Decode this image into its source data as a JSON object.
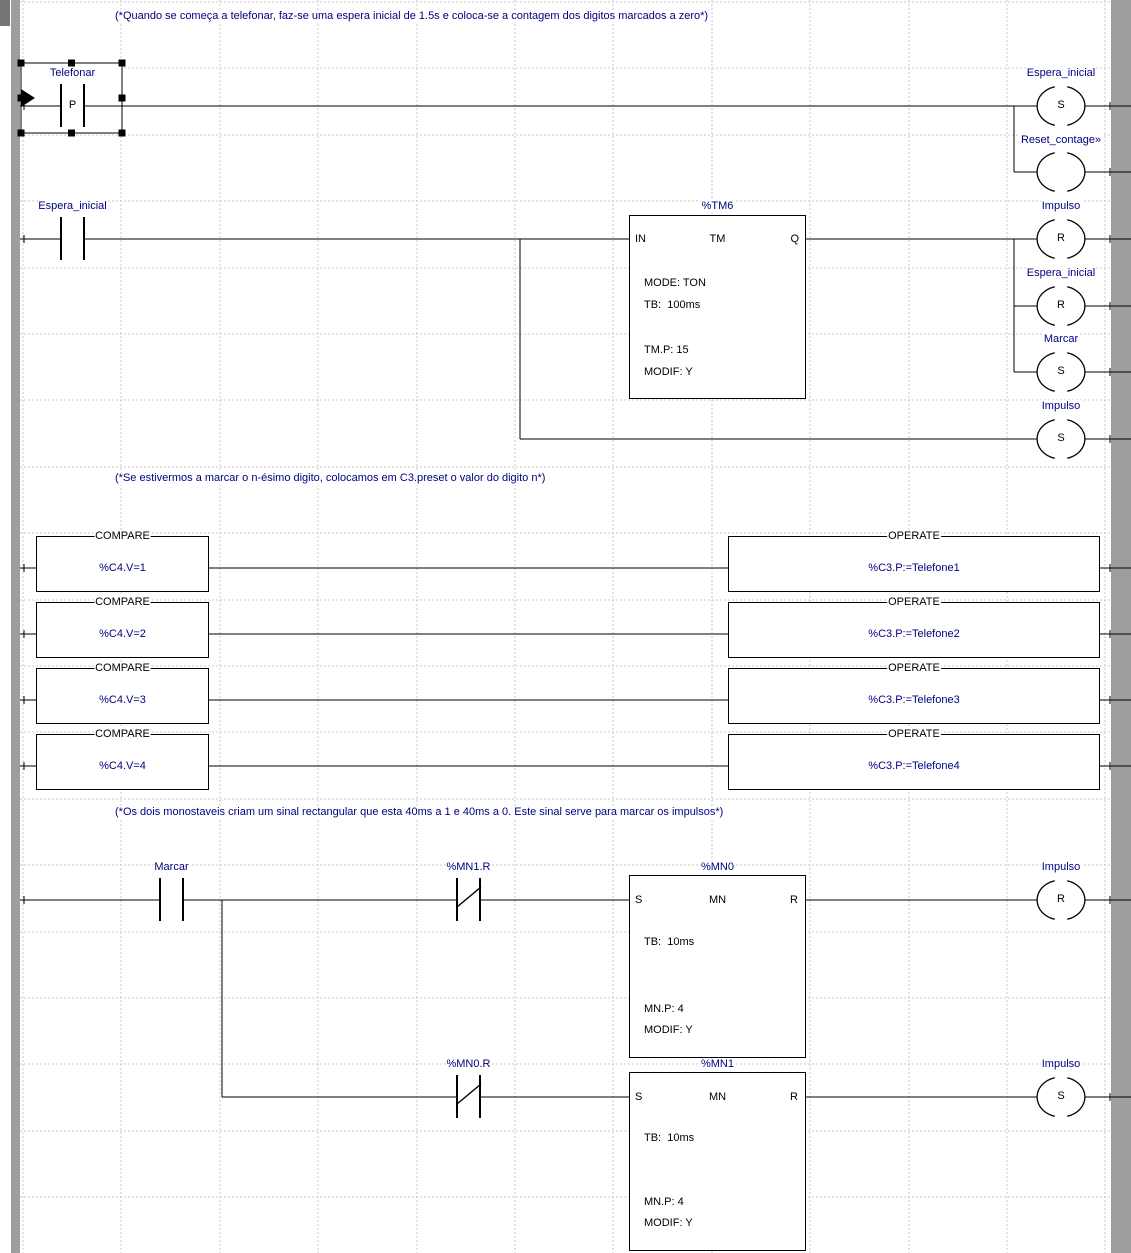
{
  "colors": {
    "label_blue": "#000080",
    "line_black": "#000000",
    "rail_gray": "#9e9e9e",
    "corner_gray": "#757575",
    "grid_gray": "#c9c9c9"
  },
  "comments": [
    "(*Quando se começa a telefonar, faz-se uma espera inicial de 1.5s e coloca-se a contagem dos digitos marcados a zero*)",
    "(*Se estivermos a marcar o n-ésimo digito, colocamos em C3.preset o valor do digito n*)",
    "(*Os dois monostaveis criam um sinal rectangular que esta 40ms a 1 e 40ms a 0. Este sinal serve para marcar os impulsos*)"
  ],
  "network1": {
    "contact_telefonar": {
      "label": "Telefonar",
      "edge": "P"
    },
    "coil_espera_set": {
      "label": "Espera_inicial",
      "op": "S"
    },
    "coil_reset_contagem": {
      "label": "Reset_contage»",
      "op": ""
    },
    "contact_espera": {
      "label": "Espera_inicial"
    },
    "timer": {
      "name": "%TM6",
      "pin_in": "IN",
      "pin_fn": "TM",
      "pin_q": "Q",
      "line_mode": "MODE: TON",
      "line_tb": "TB:  100ms",
      "line_preset": "TM.P: 15",
      "line_modif": "MODIF: Y"
    },
    "coil_impulso_r": {
      "label": "Impulso",
      "op": "R"
    },
    "coil_espera_r": {
      "label": "Espera_inicial",
      "op": "R"
    },
    "coil_marcar_s": {
      "label": "Marcar",
      "op": "S"
    },
    "coil_impulso_s": {
      "label": "Impulso",
      "op": "S"
    }
  },
  "network2": {
    "rows": [
      {
        "compare": "COMPARE",
        "expr": "%C4.V=1",
        "operate": "OPERATE",
        "assign": "%C3.P:=Telefone1"
      },
      {
        "compare": "COMPARE",
        "expr": "%C4.V=2",
        "operate": "OPERATE",
        "assign": "%C3.P:=Telefone2"
      },
      {
        "compare": "COMPARE",
        "expr": "%C4.V=3",
        "operate": "OPERATE",
        "assign": "%C3.P:=Telefone3"
      },
      {
        "compare": "COMPARE",
        "expr": "%C4.V=4",
        "operate": "OPERATE",
        "assign": "%C3.P:=Telefone4"
      }
    ]
  },
  "network3": {
    "contact_marcar": {
      "label": "Marcar"
    },
    "contact_mn1r": {
      "label": "%MN1.R"
    },
    "mono0": {
      "name": "%MN0",
      "pin_s": "S",
      "pin_fn": "MN",
      "pin_r": "R",
      "line_tb": "TB:  10ms",
      "line_preset": "MN.P: 4",
      "line_modif": "MODIF: Y"
    },
    "coil_impulso_r": {
      "label": "Impulso",
      "op": "R"
    },
    "contact_mn0r": {
      "label": "%MN0.R"
    },
    "mono1": {
      "name": "%MN1",
      "pin_s": "S",
      "pin_fn": "MN",
      "pin_r": "R",
      "line_tb": "TB:  10ms",
      "line_preset": "MN.P: 4",
      "line_modif": "MODIF: Y"
    },
    "coil_impulso_s": {
      "label": "Impulso",
      "op": "S"
    }
  }
}
